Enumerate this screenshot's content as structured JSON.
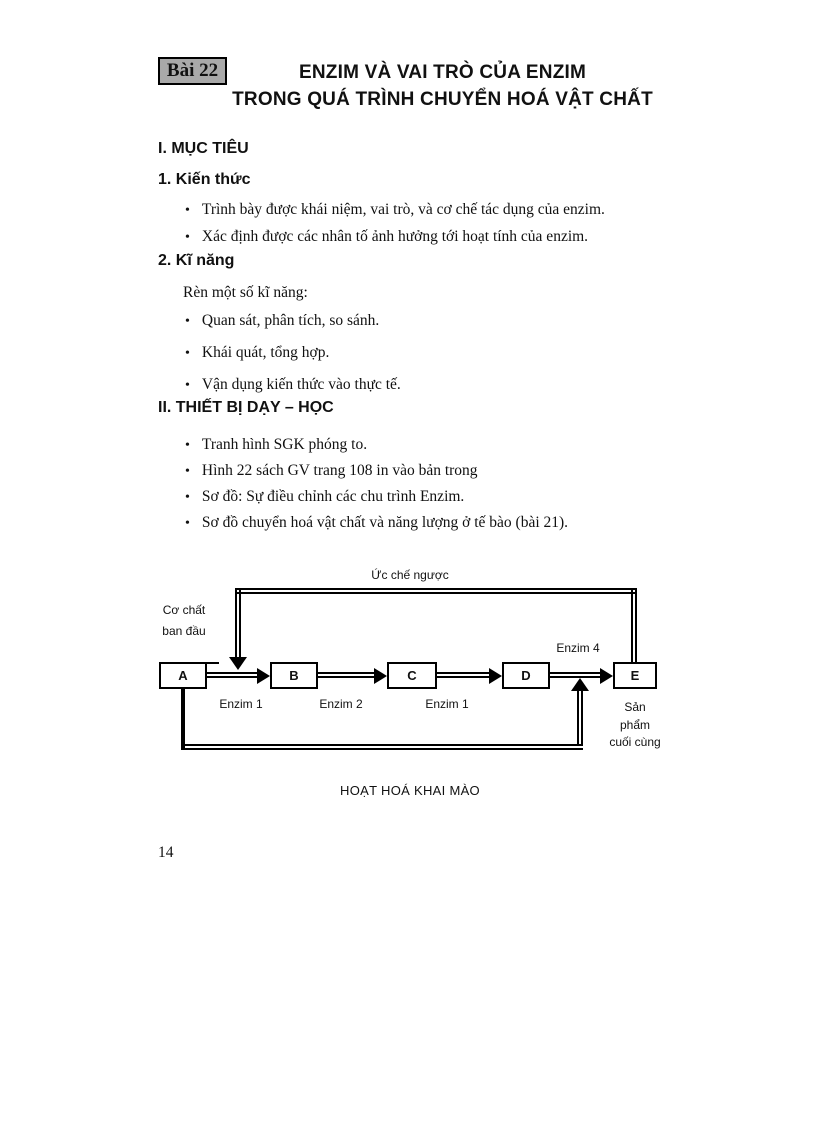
{
  "ui": {
    "bullet_char": "•"
  },
  "header": {
    "badge": "Bài 22",
    "title_line1": "ENZIM VÀ VAI TRÒ CỦA ENZIM",
    "title_line2": "TRONG QUÁ TRÌNH CHUYỂN HOÁ VẬT CHẤT"
  },
  "sections": [
    {
      "heading": "I. MỤC TIÊU",
      "subsections": [
        {
          "heading": "1. Kiến thức",
          "bullets": [
            "Trình bày được khái niệm, vai trò, và cơ chế tác dụng của enzim.",
            "Xác định được các nhân tố ảnh hưởng tới hoạt tính của enzim."
          ]
        },
        {
          "heading": "2. Kĩ năng",
          "intro": "Rèn một số kĩ năng:",
          "bullets": [
            "Quan sát, phân tích, so sánh.",
            "Khái quát, tổng hợp.",
            "Vận dụng kiến thức vào thực tế."
          ]
        }
      ]
    },
    {
      "heading": "II. THIẾT BỊ DẠY – HỌC",
      "bullets": [
        "Tranh hình SGK phóng to.",
        "Hình 22 sách GV trang 108 in vào bản trong",
        "Sơ đồ: Sự điều chỉnh các chu trình Enzim.",
        "Sơ đồ chuyển hoá vật chất và năng lượng ở tế bào (bài 21)."
      ]
    }
  ],
  "diagram": {
    "feedback_label": "Ức chế ngược",
    "substrate_label_line1": "Cơ chất",
    "substrate_label_line2": "ban đầu",
    "boxes": [
      "A",
      "B",
      "C",
      "D",
      "E"
    ],
    "enzyme_labels": [
      "Enzim 1",
      "Enzim 2",
      "Enzim 1"
    ],
    "enzyme4_label": "Enzim 4",
    "product_label_line1": "Sản",
    "product_label_line2": "phẩm",
    "product_label_line3": "cuối cùng",
    "caption": "HOẠT HOÁ KHAI MÀO"
  },
  "footer": {
    "page_number": "14"
  }
}
